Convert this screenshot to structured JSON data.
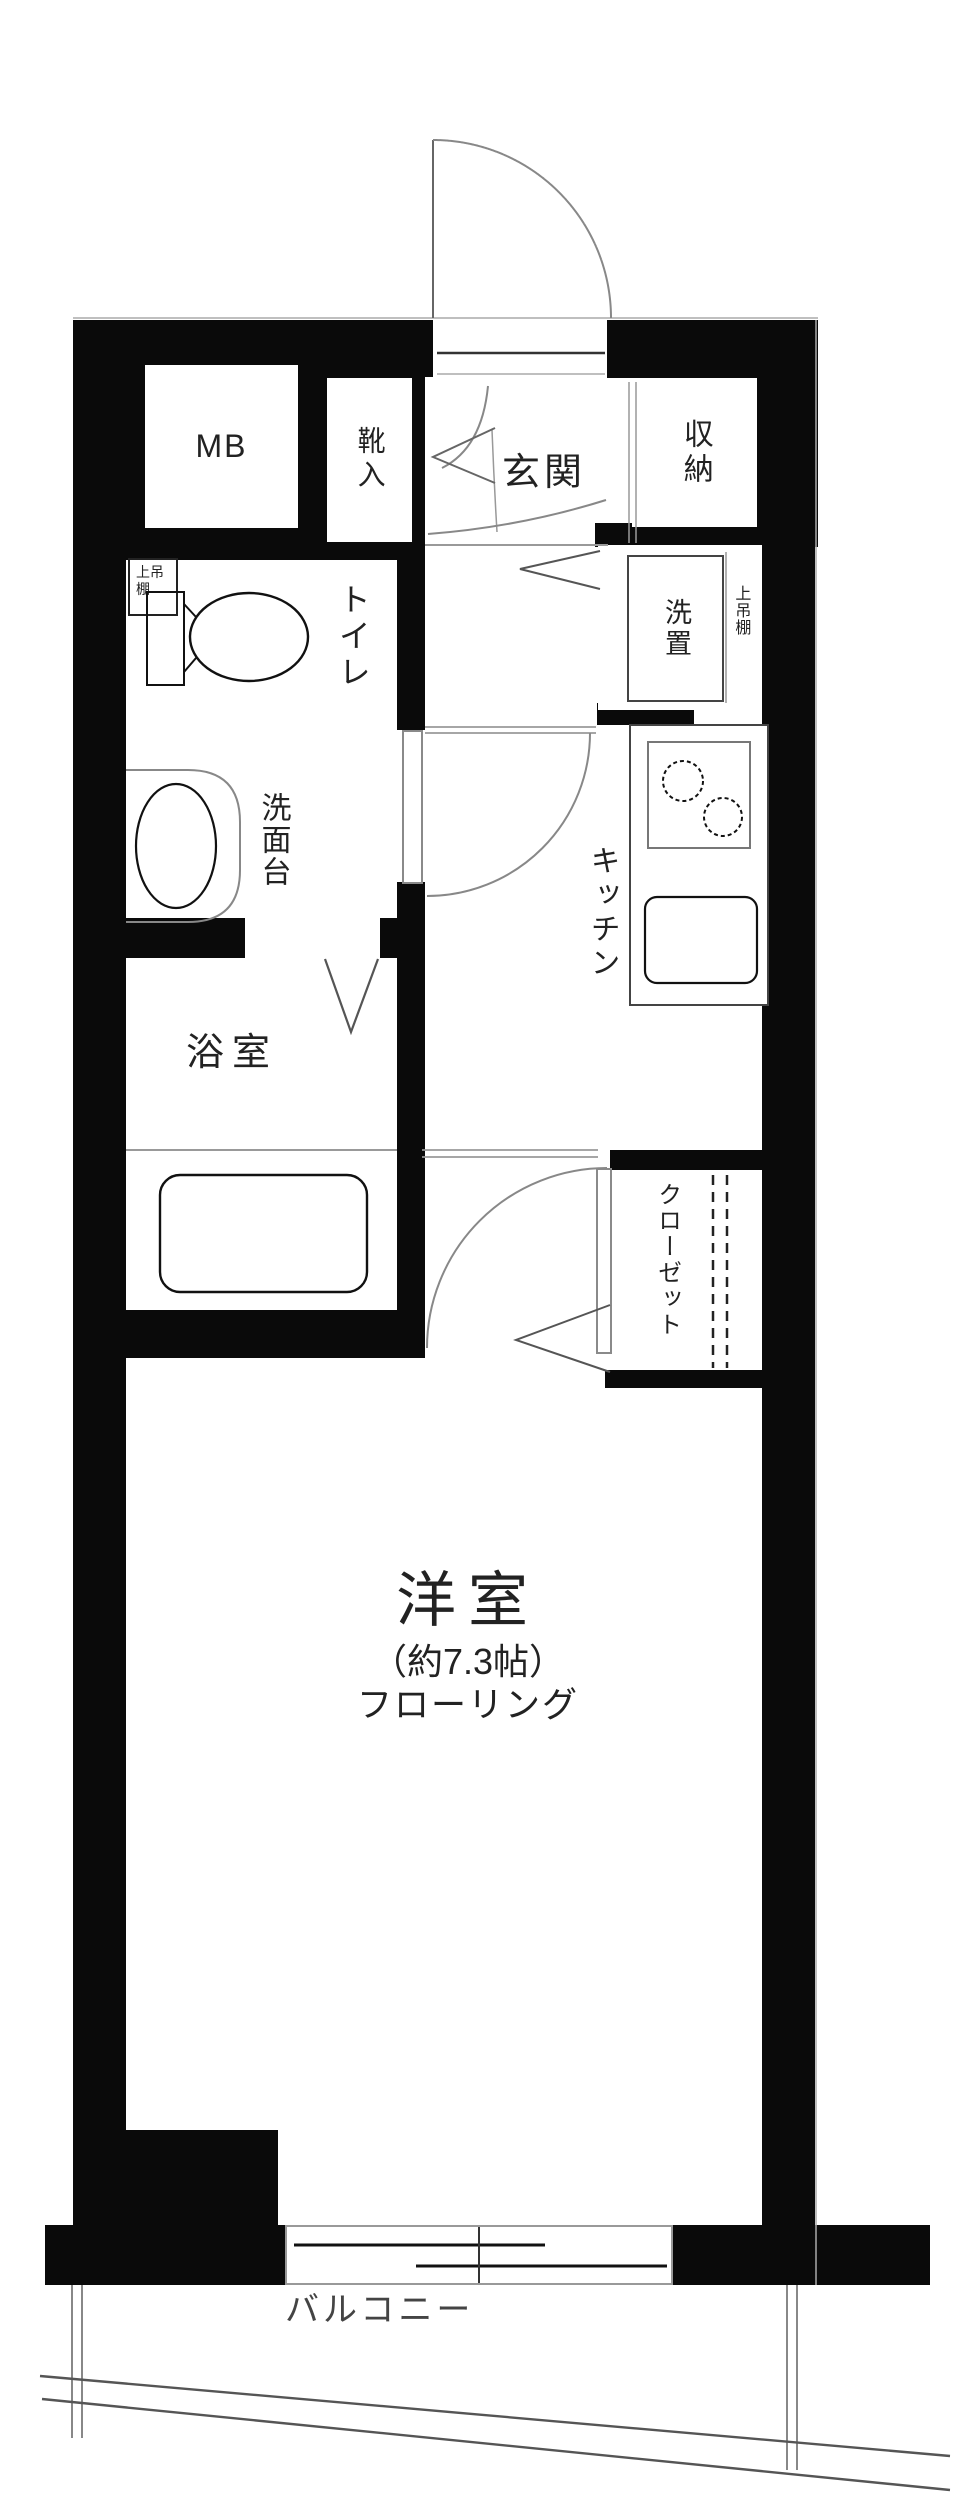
{
  "floor_plan": {
    "entrance_zone": {
      "meter_box": "MB",
      "shoe_cabinet": "靴入",
      "entrance": "玄関",
      "storage": "収納"
    },
    "utility_zone": {
      "washer_space": "洗置",
      "overhead_shelf": "上吊棚",
      "kitchen": "キッチン"
    },
    "sanitary_zone": {
      "toilet": "トイレ",
      "toilet_overhead_shelf": "上吊棚",
      "vanity": "洗面台",
      "bathroom": "浴室"
    },
    "main_room": {
      "name": "洋室",
      "size": "（約7.3帖）",
      "flooring": "フローリング",
      "closet": "クローゼット"
    },
    "outdoor": {
      "balcony": "バルコニー"
    },
    "colors": {
      "wall": "#0a0a0a",
      "thin_line": "#999999",
      "fixture_line": "#111111",
      "door_line": "#888888",
      "text": "#222222"
    }
  }
}
